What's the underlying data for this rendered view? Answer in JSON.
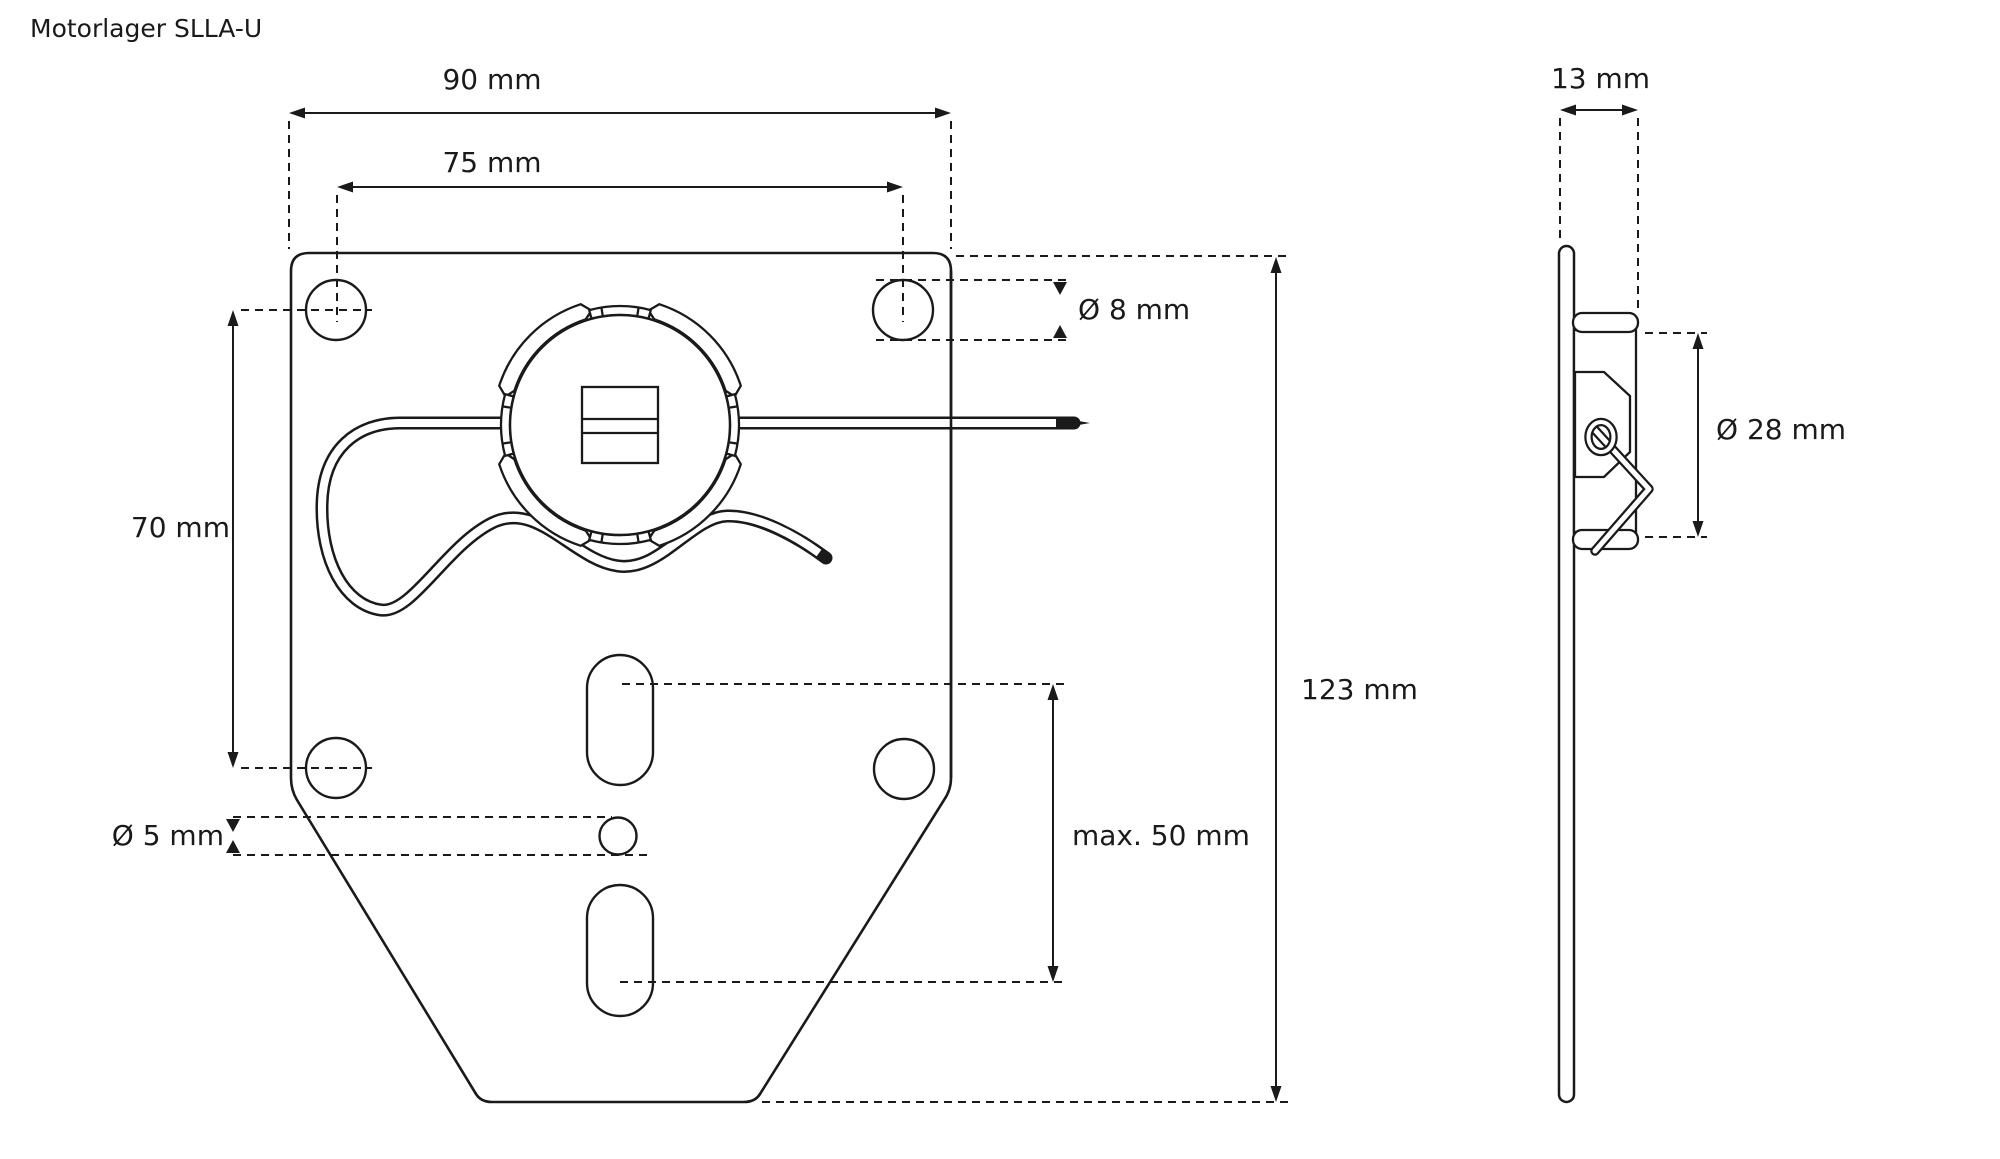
{
  "title": "Motorlager SLLA-U",
  "front_view": {
    "dims": {
      "outer_width": "90 mm",
      "hole_spacing_width": "75 mm",
      "corner_hole_diameter": "Ø 8 mm",
      "hole_spacing_height": "70 mm",
      "center_hole_diameter": "Ø 5 mm",
      "slot_span": "max. 50 mm",
      "total_height": "123 mm"
    }
  },
  "side_view": {
    "dims": {
      "thickness": "13 mm",
      "ring_diameter": "Ø 28 mm"
    }
  }
}
